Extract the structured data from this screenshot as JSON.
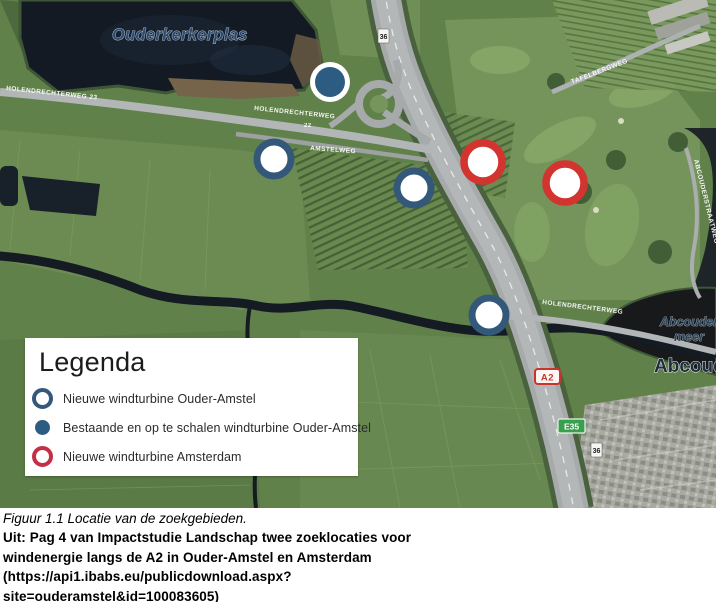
{
  "figure": {
    "caption_italic": "Figuur 1.1 Locatie van de zoekgebieden.",
    "source_lines": [
      "Uit: Pag 4 van Impactstudie Landschap twee zoeklocaties voor",
      "windenergie langs de A2 in Ouder-Amstel en Amsterdam",
      "(https://api1.ibabs.eu/publicdownload.aspx?",
      "site=ouderamstel&id=100083605)"
    ]
  },
  "legend": {
    "title": "Legenda",
    "items": [
      {
        "marker": "blue-ring",
        "label": "Nieuwe windturbine Ouder-Amstel"
      },
      {
        "marker": "blue-filled",
        "label": "Bestaande en op te schalen windturbine Ouder-Amstel"
      },
      {
        "marker": "red-ring",
        "label": "Nieuwe windturbine Amsterdam"
      }
    ]
  },
  "map": {
    "place_labels": {
      "lake": "Ouderkerkerplas",
      "meer_line1": "Abcouder",
      "meer_line2": "meer",
      "town": "Abcoude"
    },
    "street_labels": {
      "holendrechterweg_nw": "HOLENDRECHTERWEG 23",
      "holendrechterweg_mid": "HOLENDRECHTERWEG",
      "amstelweg": "AMSTELWEG",
      "holendrechterweg_east": "HOLENDRECHTERWEG",
      "tafelbergweg": "TAFELBERGWEG",
      "abcouderstraatweg": "ABCOUDERSTRAATWEG",
      "route_22": "22"
    },
    "road_shields": {
      "a2": "A2",
      "e35": "E35",
      "exit_top": "36",
      "exit_bottom": "36"
    },
    "markers": [
      {
        "kind": "blue-filled",
        "x": 330,
        "y": 82
      },
      {
        "kind": "blue-ring",
        "x": 274,
        "y": 159
      },
      {
        "kind": "blue-ring",
        "x": 414,
        "y": 188
      },
      {
        "kind": "red-ring",
        "x": 483,
        "y": 162
      },
      {
        "kind": "red-ring",
        "x": 565,
        "y": 183
      },
      {
        "kind": "blue-ring",
        "x": 489,
        "y": 315
      }
    ],
    "colors": {
      "blue": "#33587a",
      "blue_fill": "#2d5c83",
      "red": "#d23430",
      "red_legend": "#c23047"
    }
  }
}
